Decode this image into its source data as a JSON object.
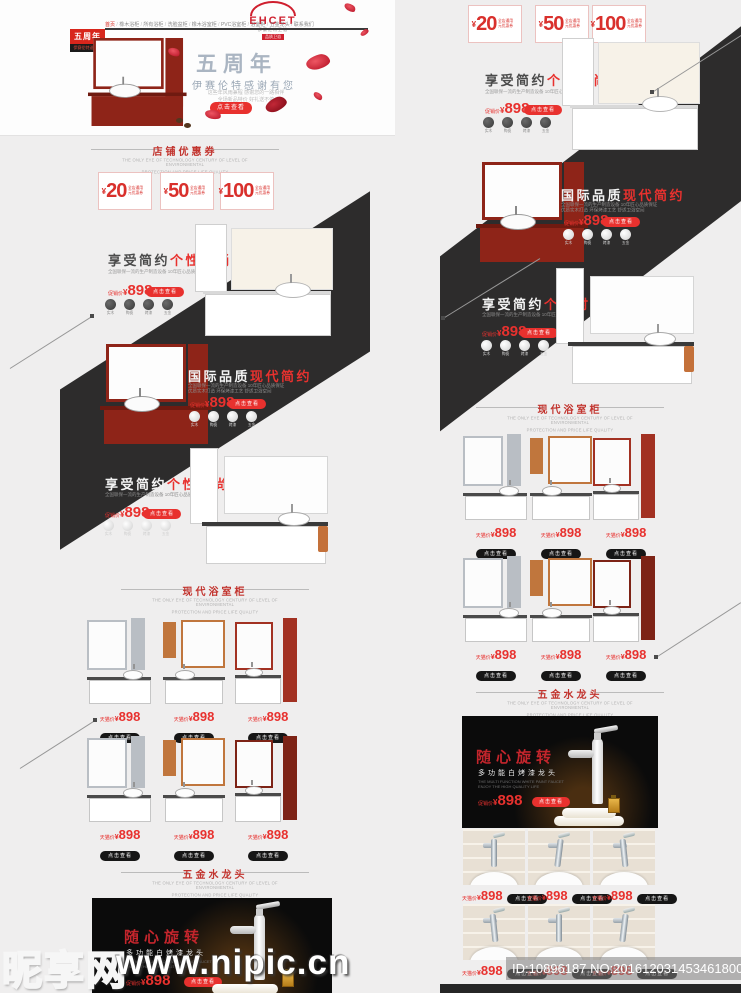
{
  "theme": {
    "accent_red": "#e8312e",
    "brand_red": "#cf1f2e",
    "band_black": "#2d2c2c",
    "dark_button": "#161616"
  },
  "watermark": {
    "site_name": "昵享网",
    "site_url": "www.nipic.cn",
    "id_label": "ID:10896187 NO:20161203145346180000"
  },
  "header": {
    "logo_text": "EHCET",
    "logo_sub": "伊赛伦特卫浴",
    "logo_tag": "品质卫浴",
    "nav_items": [
      "首页",
      "橡木浴柜",
      "所有浴柜",
      "洗脸盆柜",
      "橡木浴室柜",
      "PVC浴室柜",
      "浴室柜",
      "五金龙头",
      "联系我们"
    ],
    "anniv_badge": "五周年",
    "anniv_badge_sub": "伊赛伦特送好礼"
  },
  "banner": {
    "title": "五周年",
    "subtitle": "伊赛伦特感谢有您",
    "desc1": "这些年风雨兼程 感谢您的一路相伴",
    "desc2": "全场新品特价 好礼送不停",
    "button": "点击查看"
  },
  "coupons": {
    "section_title": "店铺优惠券",
    "section_sub1": "THE ONLY EYE OF TECHNOLOGY CENTURY OF LEVEL OF ENVIRONMENTAL",
    "section_sub2": "PROTECTION AND PRICE LIFE QUALITY",
    "currency": "¥",
    "note1": "全店通用",
    "note2": "元优惠券",
    "items": [
      "20",
      "50",
      "100"
    ]
  },
  "promos": {
    "simple_title_main": "享受简约",
    "simple_title_accent": "个性时尚",
    "intl_title_main": "国际品质",
    "intl_title_accent": "现代简约",
    "desc": "全国联保一流的生产制造设备 10年匠心品质保证",
    "desc2": "优质实木打造 环保烤漆工艺 舒适卫浴空间",
    "promo_price_label": "促销价",
    "tmall_price_label": "天猫价",
    "currency": "¥",
    "price": "898",
    "view_button": "点击查看",
    "features": [
      {
        "icon": "wood-icon",
        "label": "实木"
      },
      {
        "icon": "ceramic-icon",
        "label": "陶瓷"
      },
      {
        "icon": "paint-icon",
        "label": "烤漆"
      },
      {
        "icon": "hardware-icon",
        "label": "五金"
      }
    ]
  },
  "cabinet_section": {
    "title": "现代浴室柜",
    "sub1": "THE ONLY EYE OF TECHNOLOGY CENTURY OF LEVEL OF ENVIRONMENTAL",
    "sub2": "PROTECTION AND PRICE LIFE QUALITY"
  },
  "faucet_section": {
    "title": "五金水龙头",
    "sub1": "THE ONLY EYE OF TECHNOLOGY CENTURY OF LEVEL OF ENVIRONMENTAL",
    "sub2": "PROTECTION AND PRICE LIFE QUALITY"
  },
  "faucet_banner": {
    "title": "随心旋转",
    "subtitle": "多功能白烤漆龙头",
    "desc1": "THE MULTI FUNCTION WHITE PAINT FAUCET",
    "desc2": "ENJOY THE HIGH QUALITY LIFE",
    "price_label": "促销价",
    "currency": "¥",
    "price": "898",
    "button": "点击查看"
  }
}
